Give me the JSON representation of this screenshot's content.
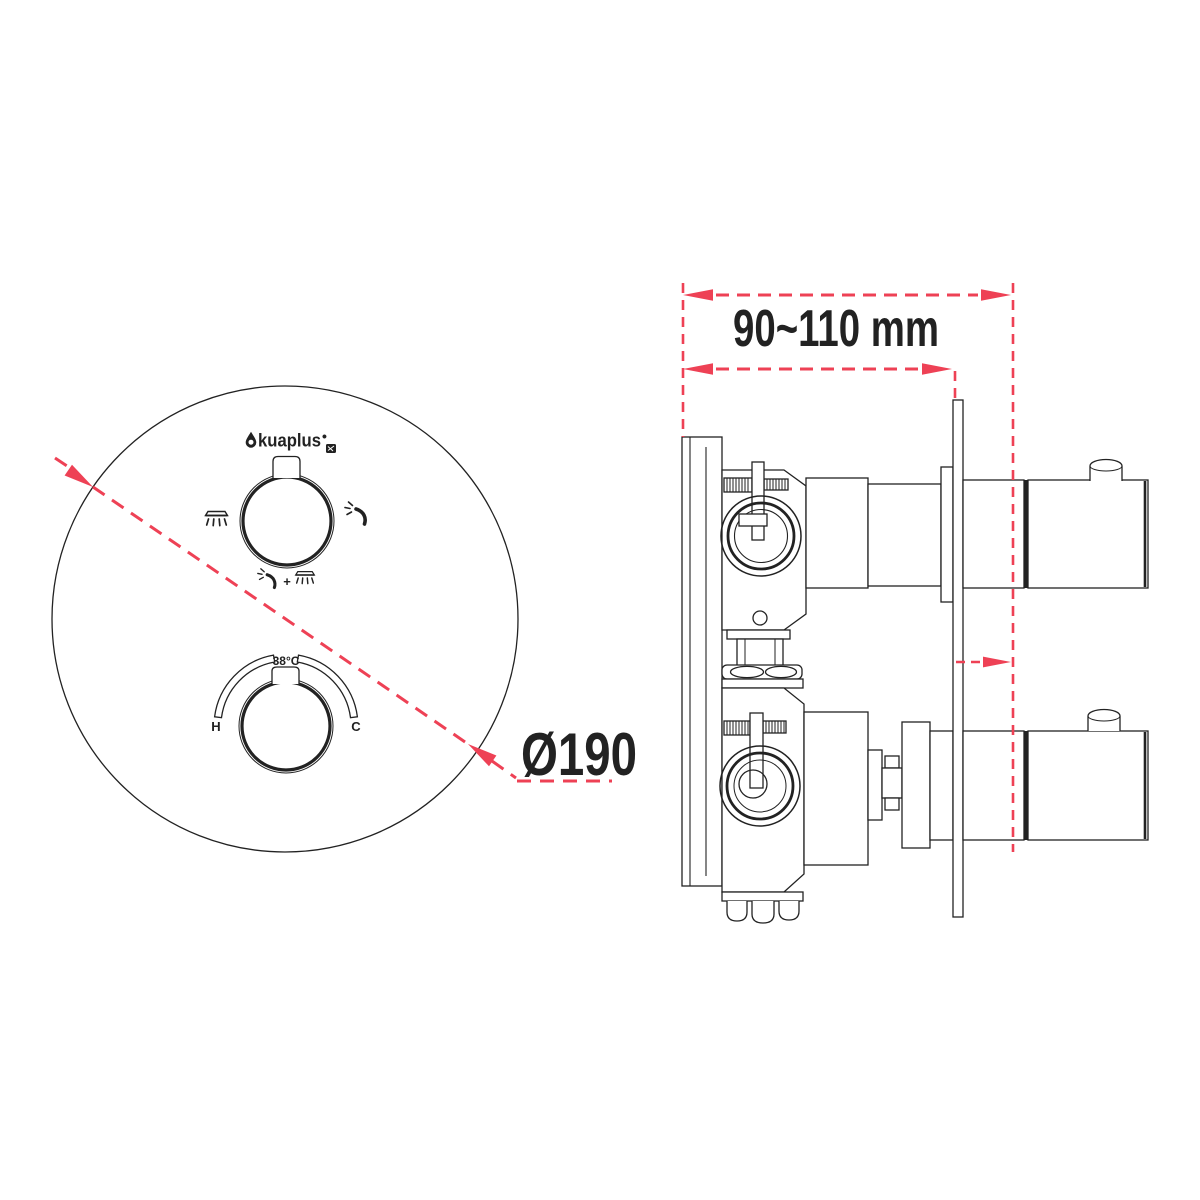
{
  "colors": {
    "ink": "#222222",
    "accent": "#ee4155",
    "background": "#ffffff"
  },
  "front_view": {
    "brand": {
      "name": "akuaplus",
      "wordmark": "kuaplus",
      "bullet": "•"
    },
    "diverter": {
      "combo_plus": "+"
    },
    "thermostat": {
      "temperature_label": "38°C",
      "hot_label": "H",
      "cold_label": "C"
    },
    "diameter_label": "Ø190",
    "diameter_mm": 190
  },
  "side_view": {
    "depth_label": "90~110 mm",
    "depth_min_mm": 90,
    "depth_max_mm": 110
  }
}
